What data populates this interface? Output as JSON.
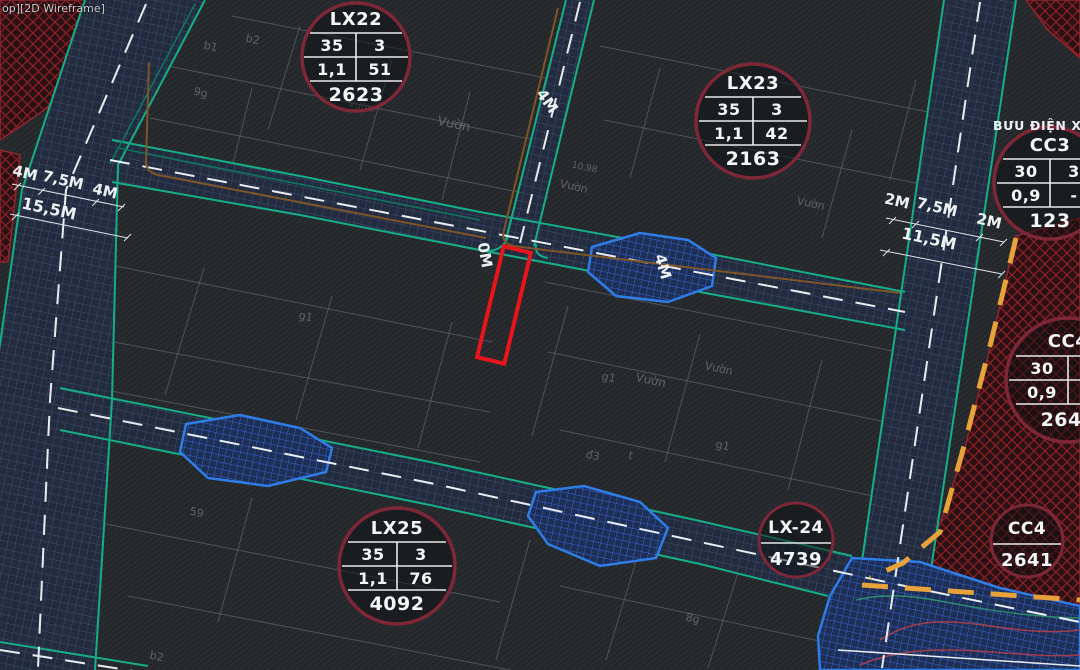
{
  "app": {
    "viewport_label": "op][2D Wireframe]"
  },
  "map": {
    "place_label": "BƯU ĐIỆN XÃ U",
    "balloons": [
      {
        "id": "LX22",
        "title": "LX22",
        "cells": [
          "35",
          "3",
          "1,1",
          "51"
        ],
        "total": "2623"
      },
      {
        "id": "LX23",
        "title": "LX23",
        "cells": [
          "35",
          "3",
          "1,1",
          "42"
        ],
        "total": "2163"
      },
      {
        "id": "CC3",
        "title": "CC3",
        "cells": [
          "30",
          "3",
          "0,9",
          "-"
        ],
        "total": "123"
      },
      {
        "id": "CC4",
        "title": "CC4",
        "cells": [
          "30",
          "3",
          "0,9",
          "-"
        ],
        "total": "2641"
      },
      {
        "id": "LX25",
        "title": "LX25",
        "cells": [
          "35",
          "3",
          "1,1",
          "76"
        ],
        "total": "4092"
      },
      {
        "id": "LX-24",
        "title": "LX-24",
        "total": "4739"
      },
      {
        "id": "CC4-B",
        "title": "CC4",
        "total": "2641"
      }
    ],
    "dimensions": [
      "4M",
      "7,5M",
      "4M",
      "15,5M",
      "2M",
      "7,5M",
      "2M",
      "11,5M",
      "4M",
      "0M",
      "4M"
    ],
    "parcel_labels": [
      "Vườn",
      "Vườn",
      "Vườn",
      "Vườn",
      "Vườn",
      "Vườn",
      "g1",
      "g1",
      "g1",
      "b1",
      "b2",
      "9g",
      "đ3",
      "t",
      "10.98",
      "59",
      "8g",
      "b2"
    ],
    "colors": {
      "background": "#25282b",
      "road_fill": "#232c3e",
      "curb_teal": "#16ae86",
      "water_outline_blue": "#2f7de6",
      "water_fill": "#1d2f55",
      "centerline_white": "#e9edf0",
      "parcel_line_gray": "#6b7076",
      "balloon_ring_maroon": "#7e2736",
      "restricted_red_hatch": "#8e2127",
      "boundary_yellow": "#e7a23a",
      "highlight_red": "#e8151c",
      "boundary_brown": "#7d5526"
    }
  }
}
